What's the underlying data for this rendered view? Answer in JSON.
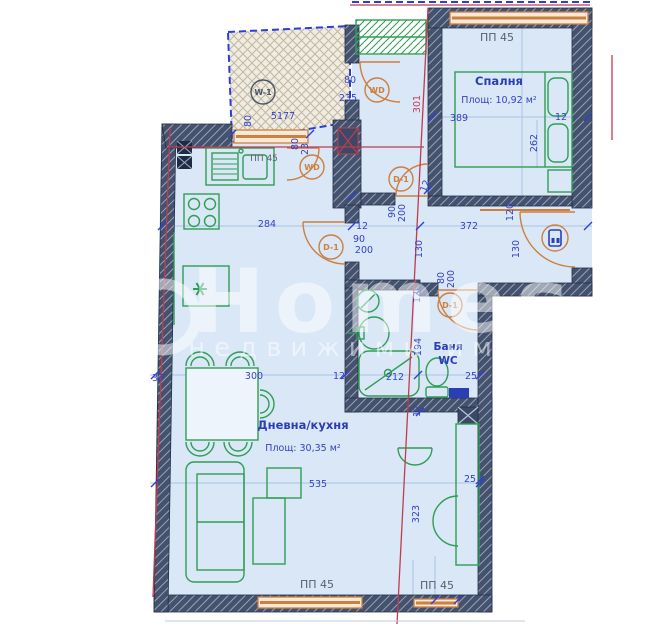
{
  "colors": {
    "room_fill": "#d9e7f7",
    "wall": "#44526d",
    "furniture_green": "#2f9e53",
    "door_window_orange": "#cd7f3e",
    "dimension_blue": "#3642c4",
    "section_red": "#c23b4e",
    "boundary_dashed_blue": "#2b3fd6",
    "label_gray": "#59616f"
  },
  "watermark": {
    "brand": "Homes",
    "tagline": "недвижими имоти"
  },
  "rooms": [
    {
      "name": "Спалня",
      "area_text": "Площ: 10,92 м²",
      "name_pos": [
        499,
        85
      ],
      "area_pos": [
        499,
        103
      ],
      "cls": "room-title",
      "area_cls": "room-area"
    },
    {
      "name": "Дневна/кухня",
      "area_text": "Площ:  30,35 м²",
      "name_pos": [
        303,
        429
      ],
      "area_pos": [
        303,
        451
      ],
      "cls": "room-title",
      "area_cls": "room-area"
    },
    {
      "name": "Баня",
      "area_text": "WC",
      "name_pos": [
        448,
        350
      ],
      "area_pos": [
        448,
        364
      ],
      "cls": "room-title-sm",
      "area_cls": "room-title-sm"
    }
  ],
  "window_labels": [
    {
      "t": "ПП 45",
      "x": 497,
      "y": 41
    },
    {
      "t": "ПП 45",
      "x": 264,
      "y": 161,
      "small": true
    },
    {
      "t": "ПП 45",
      "x": 317,
      "y": 588
    },
    {
      "t": "ПП 45",
      "x": 437,
      "y": 589
    }
  ],
  "dimensions": [
    {
      "t": "389",
      "x": 459,
      "y": 121
    },
    {
      "t": "12",
      "x": 561,
      "y": 120
    },
    {
      "t": "262",
      "x": 537,
      "y": 143,
      "r": -90
    },
    {
      "t": "301",
      "x": 420,
      "y": 104,
      "r": -90,
      "cls": "dim-red"
    },
    {
      "t": "80",
      "x": 350,
      "y": 83
    },
    {
      "t": "235",
      "x": 348,
      "y": 101
    },
    {
      "t": "80",
      "x": 251,
      "y": 121,
      "r": -90
    },
    {
      "t": "5177",
      "x": 283,
      "y": 119
    },
    {
      "t": "80",
      "x": 298,
      "y": 144,
      "r": -90
    },
    {
      "t": "23",
      "x": 308,
      "y": 149,
      "r": -90
    },
    {
      "t": "284",
      "x": 267,
      "y": 227
    },
    {
      "t": "12",
      "x": 362,
      "y": 229
    },
    {
      "t": "90",
      "x": 359,
      "y": 242
    },
    {
      "t": "200",
      "x": 364,
      "y": 253
    },
    {
      "t": "90",
      "x": 395,
      "y": 212,
      "r": -90
    },
    {
      "t": "200",
      "x": 405,
      "y": 213,
      "r": -90
    },
    {
      "t": "12",
      "x": 428,
      "y": 187,
      "r": -70
    },
    {
      "t": "372",
      "x": 469,
      "y": 229
    },
    {
      "t": "130",
      "x": 422,
      "y": 249,
      "r": -90
    },
    {
      "t": "120",
      "x": 513,
      "y": 212,
      "r": -90
    },
    {
      "t": "130",
      "x": 519,
      "y": 249,
      "r": -90
    },
    {
      "t": "80",
      "x": 444,
      "y": 278,
      "r": -90
    },
    {
      "t": "200",
      "x": 454,
      "y": 279,
      "r": -90
    },
    {
      "t": "12",
      "x": 420,
      "y": 297,
      "r": -90
    },
    {
      "t": "194",
      "x": 421,
      "y": 347,
      "r": -90
    },
    {
      "t": "12",
      "x": 339,
      "y": 379
    },
    {
      "t": "212",
      "x": 395,
      "y": 380
    },
    {
      "t": "25",
      "x": 471,
      "y": 379
    },
    {
      "t": "12",
      "x": 420,
      "y": 411,
      "r": -90
    },
    {
      "t": "33",
      "x": 158,
      "y": 381
    },
    {
      "t": "300",
      "x": 254,
      "y": 379
    },
    {
      "t": "25",
      "x": 470,
      "y": 482
    },
    {
      "t": "323",
      "x": 419,
      "y": 514,
      "r": -90
    },
    {
      "t": "535",
      "x": 318,
      "y": 487
    }
  ],
  "door_tags": [
    {
      "label": "W-1",
      "x": 263,
      "y": 92,
      "color": "#4a5568"
    },
    {
      "label": "WD",
      "x": 377,
      "y": 90,
      "color": "#cd7f3e"
    },
    {
      "label": "WD",
      "x": 312,
      "y": 167,
      "color": "#cd7f3e"
    },
    {
      "label": "D-1",
      "x": 401,
      "y": 179,
      "color": "#cd7f3e"
    },
    {
      "label": "D-1",
      "x": 331,
      "y": 247,
      "color": "#cd7f3e"
    },
    {
      "label": "D-1",
      "x": 450,
      "y": 305,
      "color": "#cd7f3e"
    }
  ]
}
